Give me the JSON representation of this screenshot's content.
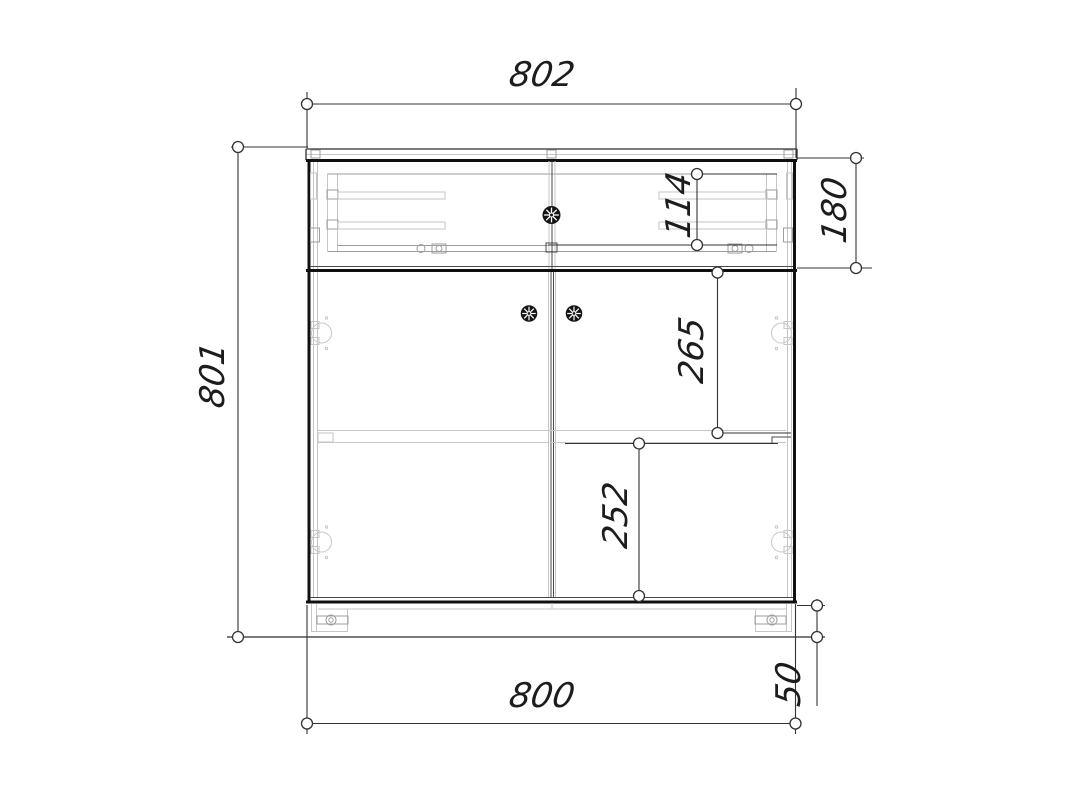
{
  "drawing": {
    "type": "furniture-technical-drawing",
    "view": "cabinet-front-elevation",
    "dimensions": {
      "top_width": "802",
      "overall_height": "801",
      "drawer_opening_height": "114",
      "drawer_section_height": "180",
      "upper_door_span": "265",
      "lower_door_span": "252",
      "bottom_width": "800",
      "plinth_height": "50"
    },
    "colors": {
      "background": "#ffffff",
      "main_line": "#101010",
      "dimension_line": "#333333",
      "hidden_detail_line": "#c6c6c6"
    }
  }
}
